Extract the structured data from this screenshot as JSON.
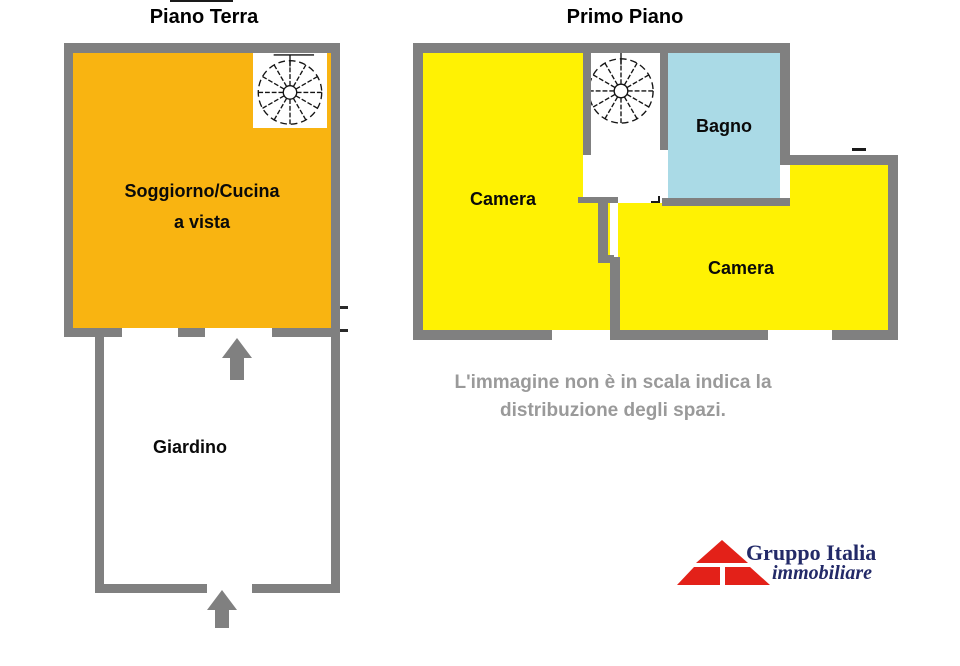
{
  "ground": {
    "title": "Piano Terra",
    "living_label_1": "Soggiorno/Cucina",
    "living_label_2": "a vista",
    "garden_label": "Giardino"
  },
  "first": {
    "title": "Primo Piano",
    "camera_left_label": "Camera",
    "bagno_label": "Bagno",
    "camera_right_label": "Camera"
  },
  "disclaimer": {
    "line1": "L'immagine non è in scala indica la",
    "line2": "distribuzione degli spazi."
  },
  "logo": {
    "title": "Gruppo Italia",
    "tagline": "immobiliare"
  },
  "icons": {
    "staircase": "spiral-staircase",
    "logo_mark": "red-pyramid",
    "entrance": "up-arrow"
  },
  "colors": {
    "wall": "#808080",
    "orange": "#F9B411",
    "yellow": "#FFF203",
    "cyan": "#AADAE6",
    "arrow": "#808080",
    "disclaimer_gray": "#9A9A9A",
    "logo_red": "#E32119",
    "logo_navy": "#232A68"
  }
}
